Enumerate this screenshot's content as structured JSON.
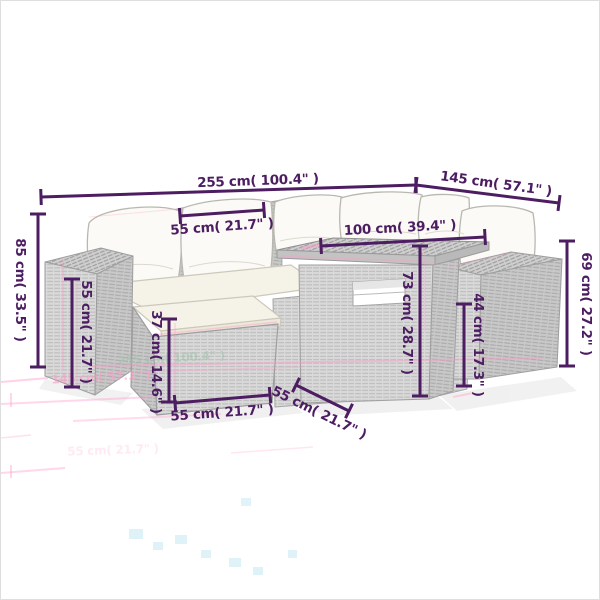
{
  "image": {
    "kind": "product-dimension-diagram",
    "subject": "poly-rattan garden lounge furniture set with cushions, ottoman and table"
  },
  "colors": {
    "dimension": "#4d1d62",
    "ghost_pink": "#ff9ac8",
    "ghost_green": "#9cc3ab",
    "wicker_light": "#d8d8d8",
    "wicker_side": "#c6c6c6",
    "cushion": "#f5f2e8",
    "pillow": "#fbfaf6"
  },
  "dimensions": [
    {
      "id": "overall-width",
      "label": "255 cm( 100.4\" )",
      "cm": 255,
      "inch": 100.4,
      "line": [
        40,
        196,
        415,
        184
      ],
      "text": [
        257,
        180,
        -2
      ]
    },
    {
      "id": "overall-depth",
      "label": "145 cm( 57.1\" )",
      "cm": 145,
      "inch": 57.1,
      "line": [
        415,
        184,
        558,
        202
      ],
      "text": [
        495,
        183,
        8
      ]
    },
    {
      "id": "seat-width",
      "label": "55 cm( 21.7\" )",
      "cm": 55,
      "inch": 21.7,
      "line": [
        179,
        215,
        263,
        209
      ],
      "text": [
        221,
        226,
        -4
      ]
    },
    {
      "id": "table-length",
      "label": "100 cm( 39.4\" )",
      "cm": 100,
      "inch": 39.4,
      "line": [
        320,
        245,
        484,
        236
      ],
      "text": [
        399,
        227,
        -3
      ]
    },
    {
      "id": "overall-height",
      "label": "85 cm( 33.5\" )",
      "cm": 85,
      "inch": 33.5,
      "line": [
        37,
        213,
        37,
        366
      ],
      "text": [
        19,
        289,
        90
      ]
    },
    {
      "id": "armrest-height",
      "label": "55 cm( 21.7\" )",
      "cm": 55,
      "inch": 21.7,
      "line": [
        71,
        278,
        71,
        386
      ],
      "text": [
        85,
        331,
        90
      ]
    },
    {
      "id": "ottoman-height",
      "label": "37 cm( 14.6\" )",
      "cm": 37,
      "inch": 14.6,
      "line": [
        168,
        318,
        168,
        401
      ],
      "text": [
        155,
        361,
        90
      ]
    },
    {
      "id": "ottoman-width",
      "label": "55 cm( 21.7\" )",
      "cm": 55,
      "inch": 21.7,
      "line": [
        174,
        402,
        269,
        394
      ],
      "text": [
        221,
        412,
        -4
      ]
    },
    {
      "id": "seat-depth",
      "label": "55 cm( 21.7\" )",
      "cm": 55,
      "inch": 21.7,
      "line": [
        295,
        384,
        348,
        410
      ],
      "text": [
        318,
        412,
        26
      ]
    },
    {
      "id": "table-height",
      "label": "73 cm( 28.7\" )",
      "cm": 73,
      "inch": 28.7,
      "line": [
        419,
        245,
        419,
        395
      ],
      "text": [
        406,
        322,
        90
      ]
    },
    {
      "id": "seat-height",
      "label": "44 cm( 17.3\" )",
      "cm": 44,
      "inch": 17.3,
      "line": [
        463,
        303,
        463,
        385
      ],
      "text": [
        477,
        344,
        90
      ]
    },
    {
      "id": "right-height",
      "label": "69 cm( 27.2\" )",
      "cm": 69,
      "inch": 27.2,
      "line": [
        566,
        240,
        566,
        365
      ],
      "text": [
        585,
        303,
        90
      ]
    }
  ],
  "ghost_labels": [
    {
      "id": "reflect-overall-width",
      "label": "255 cm( 100.4\" )",
      "text": [
        170,
        357,
        -3
      ],
      "color": "green",
      "opacity": 0.55
    },
    {
      "id": "reflect-overall-depth",
      "label": "145 cm( 57.1\" )",
      "text": [
        100,
        376,
        -3
      ],
      "color": "pink",
      "opacity": 0.6
    },
    {
      "id": "reflect-ottoman-width",
      "label": "55 cm( 21.7\" )",
      "text": [
        112,
        449,
        -2
      ],
      "color": "pink",
      "opacity": 0.2
    }
  ]
}
